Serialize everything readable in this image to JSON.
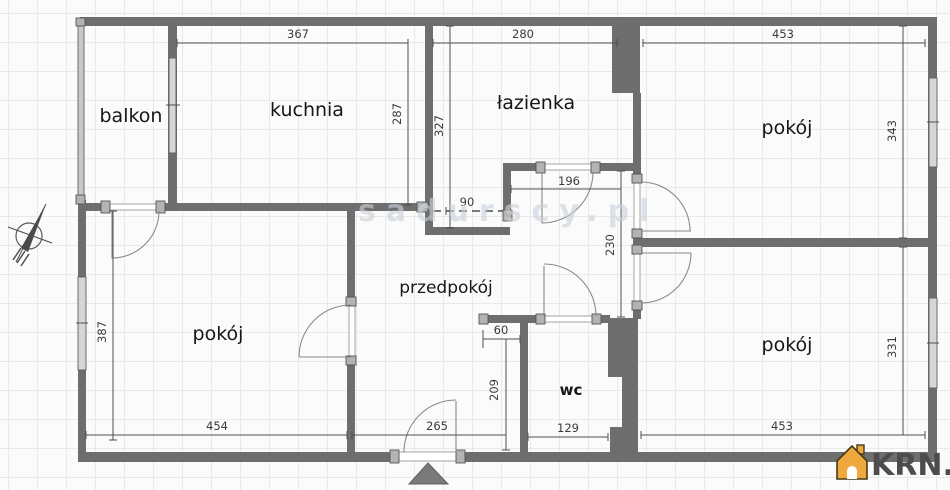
{
  "plan": {
    "rooms": {
      "balkon": "balkon",
      "kuchnia": "kuchnia",
      "lazienka": "łazienka",
      "pokoj_top_right": "pokój",
      "pokoj_bottom_left": "pokój",
      "pokoj_bottom_right": "pokój",
      "przedpokoj": "przedpokój",
      "wc": "wc"
    },
    "dims": {
      "kuchnia_width": "367",
      "lazienka_width": "280",
      "pokoj_tr_width": "453",
      "kuchnia_height": "287",
      "lazienka_height": "327",
      "pokoj_tr_height": "343",
      "kuchnia_opening": "90",
      "lazienka_door_wall": "196",
      "hall_height": "230",
      "pokoj_bl_height": "387",
      "pokoj_bl_width": "454",
      "hall_width": "265",
      "hall_nook": "60",
      "wc_height": "209",
      "wc_width": "129",
      "pokoj_br_width": "453",
      "pokoj_br_height": "331"
    }
  },
  "watermark": {
    "text": "sadurscy.pl"
  },
  "branding": {
    "logo_text": "KRN.pl"
  },
  "icons": {
    "north_arrow": "north-arrow",
    "entrance_arrow": "entrance-arrow",
    "logo_house": "house"
  },
  "colors": {
    "wall": "#6e6e6e",
    "window_fill": "#d6d6d6",
    "dimension": "#3a3a3a",
    "watermark": "#c9d2da",
    "logo_accent": "#efa83e",
    "logo_text": "#4d4d4d"
  }
}
